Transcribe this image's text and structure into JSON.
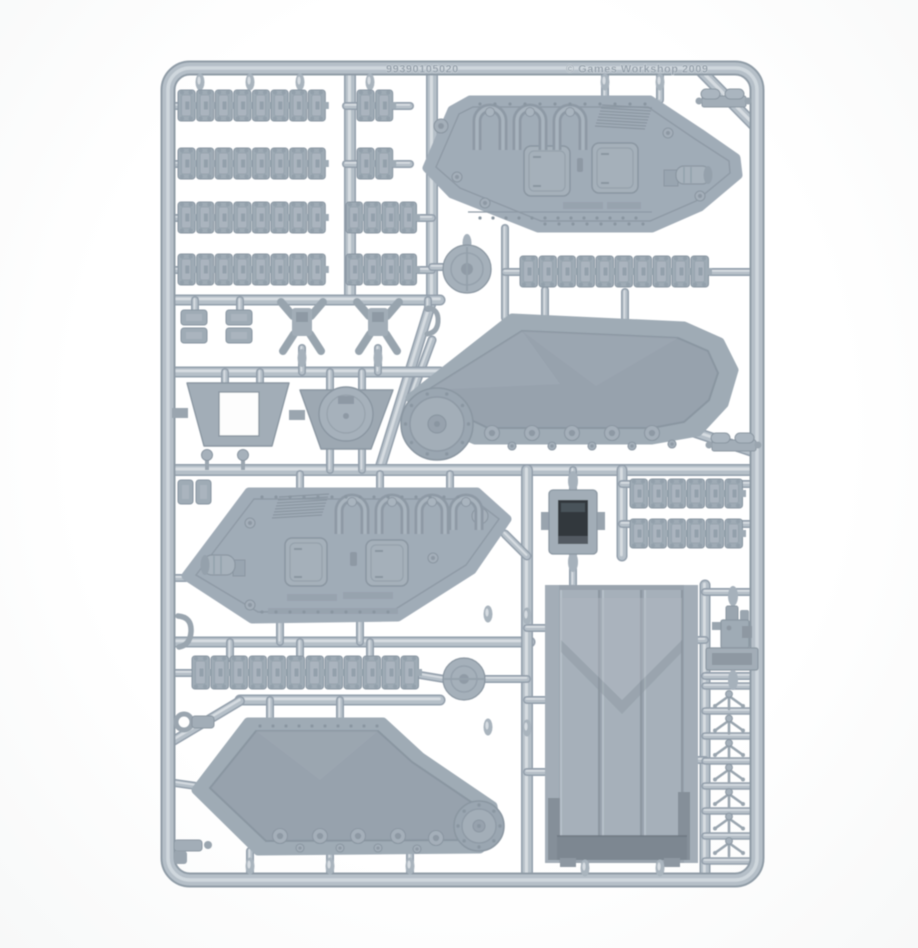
{
  "photo": {
    "subject": "plastic-model-sprue",
    "description": "Light grey plastic sprue frame of tank model parts photographed on white",
    "copyright_embossed": "© Games Workshop 2009",
    "mold_code_embossed": "99390105020",
    "plastic_color": "#b5bfc8",
    "plastic_shadow_color": "#939fab",
    "plastic_highlight_color": "#d6dce1",
    "part_color": "#a0acb6",
    "recess_color": "#97a2ad",
    "deep_recess_color": "#30373e",
    "background_color": "#ffffff"
  },
  "parts": {
    "track_runs": [
      {
        "links": 8
      },
      {
        "links": 2
      },
      {
        "links": 8
      },
      {
        "links": 2
      },
      {
        "links": 8
      },
      {
        "links": 4
      },
      {
        "links": 8
      },
      {
        "links": 4
      },
      {
        "links": 10
      },
      {
        "links": 6
      },
      {
        "links": 6
      },
      {
        "links": 12
      }
    ],
    "handle_count": 7,
    "inventory": [
      {
        "name": "hull-side-panel",
        "count": 2
      },
      {
        "name": "inner-track-housing-panel",
        "count": 2
      },
      {
        "name": "assault-ramp-door",
        "count": 1
      },
      {
        "name": "track-link-run",
        "count": 12
      },
      {
        "name": "idler-wheel-disc",
        "count": 2
      },
      {
        "name": "hatch-frame",
        "count": 1
      },
      {
        "name": "dome-hatch",
        "count": 1
      },
      {
        "name": "hatch-housing-box",
        "count": 1
      },
      {
        "name": "drive-sprocket-mount",
        "count": 2
      },
      {
        "name": "door-handle",
        "count": 7
      },
      {
        "name": "small-bracket",
        "count": 6
      },
      {
        "name": "engine-assembly",
        "count": 1
      }
    ]
  }
}
